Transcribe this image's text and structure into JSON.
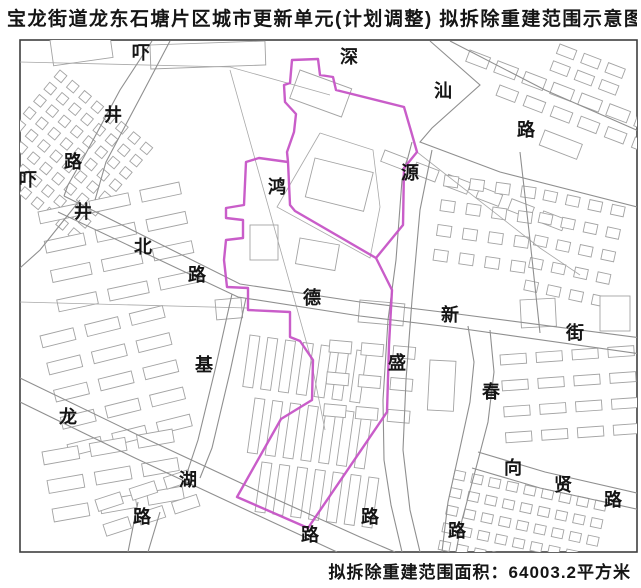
{
  "title": "宝龙街道龙东石塘片区城市更新单元(计划调整) 拟拆除重建范围示意图",
  "caption": "拟拆除重建范围面积：64003.2平方米",
  "colors": {
    "boundary": "#c654c6",
    "road": "#8f8f8f",
    "parcel": "#a8a8a8",
    "building": "#a3a3a3",
    "frame": "#3f3f3f",
    "text": "#151515"
  },
  "map": {
    "frame": {
      "x": 20,
      "y": 40,
      "w": 617,
      "h": 512
    },
    "labels": [
      {
        "t": "深",
        "x": 349,
        "y": 57
      },
      {
        "t": "汕",
        "x": 443,
        "y": 91
      },
      {
        "t": "路",
        "x": 526,
        "y": 130
      },
      {
        "t": "吓",
        "x": 141,
        "y": 53
      },
      {
        "t": "井",
        "x": 113,
        "y": 115
      },
      {
        "t": "路",
        "x": 73,
        "y": 162
      },
      {
        "t": "吓",
        "x": 28,
        "y": 180
      },
      {
        "t": "井",
        "x": 83,
        "y": 212
      },
      {
        "t": "北",
        "x": 143,
        "y": 247
      },
      {
        "t": "路",
        "x": 197,
        "y": 275
      },
      {
        "t": "鸿",
        "x": 277,
        "y": 187
      },
      {
        "t": "源",
        "x": 410,
        "y": 173
      },
      {
        "t": "德",
        "x": 312,
        "y": 298
      },
      {
        "t": "新",
        "x": 450,
        "y": 315
      },
      {
        "t": "街",
        "x": 575,
        "y": 333
      },
      {
        "t": "盛",
        "x": 397,
        "y": 363
      },
      {
        "t": "基",
        "x": 204,
        "y": 365
      },
      {
        "t": "春",
        "x": 491,
        "y": 392
      },
      {
        "t": "龙",
        "x": 68,
        "y": 417
      },
      {
        "t": "湖",
        "x": 188,
        "y": 480
      },
      {
        "t": "向",
        "x": 513,
        "y": 468
      },
      {
        "t": "贤",
        "x": 563,
        "y": 485
      },
      {
        "t": "路",
        "x": 613,
        "y": 500
      },
      {
        "t": "路",
        "x": 142,
        "y": 517
      },
      {
        "t": "路",
        "x": 310,
        "y": 535
      },
      {
        "t": "路",
        "x": 370,
        "y": 517
      },
      {
        "t": "路",
        "x": 457,
        "y": 531
      }
    ],
    "roads": [
      {
        "name": "shenshan-road-upper",
        "points": [
          [
            450,
            41
          ],
          [
            545,
            90
          ],
          [
            641,
            132
          ]
        ]
      },
      {
        "name": "shenshan-road-lower",
        "points": [
          [
            430,
            41
          ],
          [
            480,
            85
          ],
          [
            432,
            128
          ],
          [
            420,
            142
          ],
          [
            500,
            172
          ],
          [
            641,
            208
          ]
        ]
      },
      {
        "name": "xiajing-road-west",
        "points": [
          [
            152,
            41
          ],
          [
            120,
            90
          ],
          [
            85,
            155
          ],
          [
            68,
            185
          ],
          [
            64,
            196
          ]
        ]
      },
      {
        "name": "xiajing-road-east",
        "points": [
          [
            170,
            41
          ],
          [
            140,
            98
          ],
          [
            106,
            162
          ],
          [
            95,
            200
          ]
        ]
      },
      {
        "name": "xiajingbei-dexin-north",
        "points": [
          [
            64,
            196
          ],
          [
            240,
            284
          ],
          [
            360,
            302
          ],
          [
            450,
            313
          ],
          [
            641,
            338
          ]
        ]
      },
      {
        "name": "xiajingbei-dexin-south",
        "points": [
          [
            58,
            212
          ],
          [
            238,
            297
          ],
          [
            360,
            316
          ],
          [
            450,
            327
          ],
          [
            641,
            354
          ]
        ]
      },
      {
        "name": "yuansheng-road-west",
        "points": [
          [
            412,
            142
          ],
          [
            402,
            180
          ],
          [
            396,
            260
          ],
          [
            388,
            320
          ],
          [
            383,
            400
          ],
          [
            384,
            460
          ],
          [
            391,
            505
          ],
          [
            402,
            552
          ]
        ]
      },
      {
        "name": "yuansheng-road-east",
        "points": [
          [
            432,
            150
          ],
          [
            420,
            210
          ],
          [
            412,
            300
          ],
          [
            406,
            380
          ],
          [
            403,
            450
          ],
          [
            410,
            510
          ],
          [
            420,
            552
          ]
        ]
      },
      {
        "name": "chun-road-west",
        "points": [
          [
            468,
            326
          ],
          [
            474,
            362
          ],
          [
            470,
            402
          ],
          [
            460,
            448
          ],
          [
            448,
            502
          ],
          [
            442,
            552
          ]
        ]
      },
      {
        "name": "chun-road-east",
        "points": [
          [
            490,
            330
          ],
          [
            494,
            372
          ],
          [
            488,
            422
          ],
          [
            476,
            468
          ],
          [
            462,
            520
          ],
          [
            456,
            552
          ]
        ]
      },
      {
        "name": "xiangxian-road-upper",
        "points": [
          [
            478,
            452
          ],
          [
            545,
            472
          ],
          [
            641,
            494
          ]
        ]
      },
      {
        "name": "xiangxian-road-lower",
        "points": [
          [
            472,
            468
          ],
          [
            540,
            488
          ],
          [
            641,
            510
          ]
        ]
      },
      {
        "name": "longhu-road-upper",
        "points": [
          [
            20,
            378
          ],
          [
            140,
            436
          ],
          [
            260,
            492
          ],
          [
            360,
            537
          ],
          [
            395,
            552
          ]
        ]
      },
      {
        "name": "longhu-road-lower",
        "points": [
          [
            20,
            402
          ],
          [
            135,
            458
          ],
          [
            255,
            514
          ],
          [
            337,
            552
          ]
        ]
      },
      {
        "name": "ji-road-west",
        "points": [
          [
            232,
            294
          ],
          [
            215,
            370
          ],
          [
            198,
            440
          ],
          [
            188,
            470
          ]
        ]
      },
      {
        "name": "ji-road-east",
        "points": [
          [
            246,
            298
          ],
          [
            230,
            372
          ],
          [
            212,
            448
          ],
          [
            200,
            478
          ]
        ]
      },
      {
        "name": "southwest-branch",
        "points": [
          [
            80,
            200
          ],
          [
            40,
            250
          ],
          [
            20,
            268
          ]
        ]
      },
      {
        "name": "south-branch-west",
        "points": [
          [
            138,
            502
          ],
          [
            128,
            552
          ]
        ]
      },
      {
        "name": "south-branch-east",
        "points": [
          [
            160,
            512
          ],
          [
            148,
            552
          ]
        ]
      },
      {
        "name": "east-connector",
        "points": [
          [
            520,
            152
          ],
          [
            530,
            240
          ],
          [
            540,
            333
          ]
        ]
      }
    ],
    "parcel_lines": [
      {
        "points": [
          [
            20,
            62
          ],
          [
            230,
            67
          ],
          [
            330,
            95
          ]
        ]
      },
      {
        "points": [
          [
            230,
            70
          ],
          [
            310,
            355
          ],
          [
            325,
            430
          ]
        ]
      },
      {
        "points": [
          [
            320,
            133
          ],
          [
            373,
            150
          ],
          [
            380,
            207
          ],
          [
            370,
            258
          ],
          [
            277,
            207
          ],
          [
            320,
            133
          ]
        ]
      },
      {
        "points": [
          [
            20,
            302
          ],
          [
            248,
            308
          ]
        ]
      },
      {
        "points": [
          [
            417,
            152
          ],
          [
            540,
            248
          ],
          [
            580,
            275
          ]
        ]
      }
    ],
    "boundary_subpaths": [
      [
        [
          376,
          258
        ],
        [
          403,
          225
        ],
        [
          404,
          168
        ],
        [
          417,
          152
        ],
        [
          411,
          131
        ],
        [
          404,
          107
        ],
        [
          336,
          90
        ],
        [
          333,
          77
        ],
        [
          320,
          75
        ],
        [
          318,
          59
        ],
        [
          292,
          60
        ],
        [
          290,
          83
        ],
        [
          284,
          85
        ],
        [
          285,
          102
        ],
        [
          296,
          114
        ],
        [
          294,
          132
        ],
        [
          287,
          152
        ],
        [
          288,
          162
        ],
        [
          290,
          205
        ],
        [
          295,
          211
        ]
      ],
      [
        [
          288,
          162
        ],
        [
          259,
          158
        ],
        [
          246,
          162
        ],
        [
          244,
          205
        ],
        [
          226,
          208
        ],
        [
          226,
          218
        ],
        [
          243,
          220
        ],
        [
          243,
          238
        ],
        [
          226,
          240
        ],
        [
          224,
          260
        ],
        [
          227,
          287
        ],
        [
          248,
          288
        ],
        [
          248,
          310
        ],
        [
          290,
          312
        ],
        [
          290,
          337
        ],
        [
          300,
          341
        ],
        [
          313,
          360
        ],
        [
          312,
          400
        ],
        [
          281,
          419
        ],
        [
          237,
          497
        ],
        [
          308,
          528
        ],
        [
          387,
          412
        ],
        [
          389,
          345
        ],
        [
          392,
          290
        ],
        [
          376,
          258
        ],
        [
          295,
          211
        ],
        [
          290,
          205
        ]
      ]
    ],
    "building_clusters": [
      {
        "x": 60,
        "y": 70,
        "rows": 8,
        "cols": 8,
        "w": 9,
        "h": 9,
        "gx": 7,
        "gy": 7,
        "angle": 40
      },
      {
        "x": 38,
        "y": 212,
        "rows": 4,
        "cols": 3,
        "w": 40,
        "h": 12,
        "gx": 12,
        "gy": 18,
        "angle": -12
      },
      {
        "x": 40,
        "y": 336,
        "rows": 5,
        "cols": 3,
        "w": 34,
        "h": 12,
        "gx": 12,
        "gy": 16,
        "angle": -14
      },
      {
        "x": 42,
        "y": 452,
        "rows": 3,
        "cols": 3,
        "w": 36,
        "h": 13,
        "gx": 12,
        "gy": 16,
        "angle": -10
      },
      {
        "x": 470,
        "y": 50,
        "rows": 1,
        "cols": 7,
        "w": 22,
        "h": 12,
        "gx": 8,
        "gy": 0,
        "angle": 21
      },
      {
        "x": 500,
        "y": 85,
        "rows": 1,
        "cols": 6,
        "w": 20,
        "h": 11,
        "gx": 9,
        "gy": 0,
        "angle": 21
      },
      {
        "x": 385,
        "y": 150,
        "rows": 1,
        "cols": 6,
        "w": 24,
        "h": 12,
        "gx": 10,
        "gy": 0,
        "angle": 21
      },
      {
        "x": 445,
        "y": 175,
        "rows": 4,
        "cols": 4,
        "w": 14,
        "h": 11,
        "gx": 12,
        "gy": 14,
        "angle": 8
      },
      {
        "x": 545,
        "y": 190,
        "rows": 5,
        "cols": 4,
        "w": 13,
        "h": 10,
        "gx": 10,
        "gy": 13,
        "angle": 12
      },
      {
        "x": 500,
        "y": 355,
        "rows": 4,
        "cols": 4,
        "w": 26,
        "h": 10,
        "gx": 10,
        "gy": 16,
        "angle": -4
      },
      {
        "x": 455,
        "y": 470,
        "rows": 5,
        "cols": 9,
        "w": 11,
        "h": 9,
        "gx": 7,
        "gy": 9,
        "angle": 12
      },
      {
        "x": 250,
        "y": 335,
        "rows": 1,
        "cols": 7,
        "w": 10,
        "h": 52,
        "gx": 8,
        "gy": 0,
        "angle": 8
      },
      {
        "x": 255,
        "y": 398,
        "rows": 1,
        "cols": 7,
        "w": 10,
        "h": 55,
        "gx": 8,
        "gy": 0,
        "angle": 8
      },
      {
        "x": 262,
        "y": 462,
        "rows": 1,
        "cols": 7,
        "w": 10,
        "h": 50,
        "gx": 8,
        "gy": 0,
        "angle": 8
      },
      {
        "x": 330,
        "y": 340,
        "rows": 3,
        "cols": 3,
        "w": 22,
        "h": 12,
        "gx": 10,
        "gy": 20,
        "angle": 5
      },
      {
        "x": 95,
        "y": 500,
        "rows": 2,
        "cols": 3,
        "w": 26,
        "h": 12,
        "gx": 10,
        "gy": 14,
        "angle": -18
      },
      {
        "x": 560,
        "y": 44,
        "rows": 2,
        "cols": 3,
        "w": 18,
        "h": 10,
        "gx": 8,
        "gy": 8,
        "angle": 21
      }
    ],
    "buildings": [
      {
        "x": 50,
        "y": 40,
        "w": 60,
        "h": 26,
        "angle": -8
      },
      {
        "x": 150,
        "y": 45,
        "w": 115,
        "h": 24,
        "angle": -2
      },
      {
        "x": 300,
        "y": 70,
        "w": 55,
        "h": 30,
        "angle": 20
      },
      {
        "x": 315,
        "y": 158,
        "w": 60,
        "h": 40,
        "angle": 14
      },
      {
        "x": 250,
        "y": 225,
        "w": 28,
        "h": 35,
        "angle": 0
      },
      {
        "x": 300,
        "y": 238,
        "w": 40,
        "h": 26,
        "angle": 10
      },
      {
        "x": 360,
        "y": 300,
        "w": 45,
        "h": 22,
        "angle": 5
      },
      {
        "x": 600,
        "y": 296,
        "w": 30,
        "h": 35,
        "angle": 0
      },
      {
        "x": 430,
        "y": 360,
        "w": 26,
        "h": 50,
        "angle": 3
      },
      {
        "x": 520,
        "y": 300,
        "w": 35,
        "h": 28,
        "angle": -3
      },
      {
        "x": 545,
        "y": 130,
        "w": 40,
        "h": 16,
        "angle": 21
      },
      {
        "x": 215,
        "y": 300,
        "w": 26,
        "h": 20,
        "angle": -5
      }
    ]
  }
}
